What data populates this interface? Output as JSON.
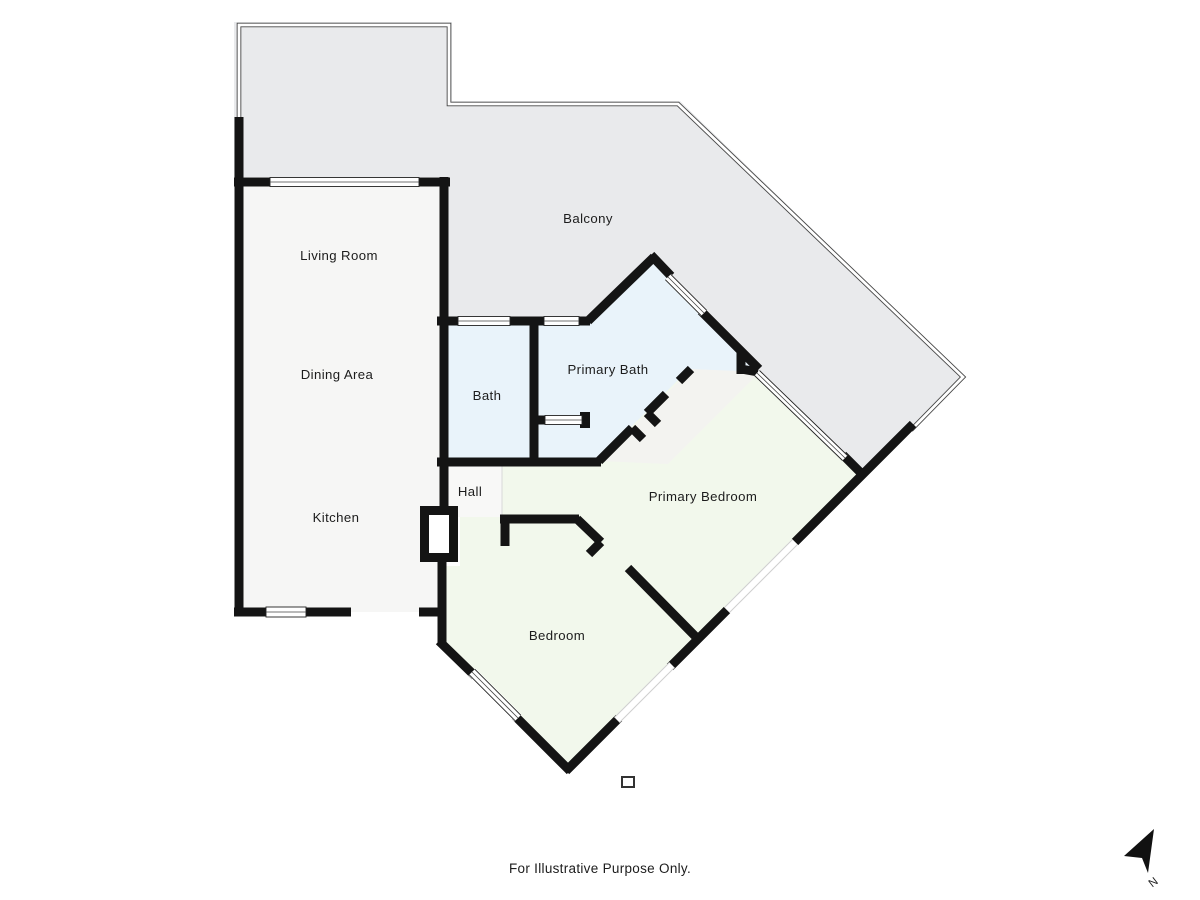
{
  "rooms": [
    {
      "id": "balcony",
      "label": "Balcony"
    },
    {
      "id": "living-room",
      "label": "Living Room"
    },
    {
      "id": "dining-area",
      "label": "Dining Area"
    },
    {
      "id": "kitchen",
      "label": "Kitchen"
    },
    {
      "id": "bath",
      "label": "Bath"
    },
    {
      "id": "primary-bath",
      "label": "Primary Bath"
    },
    {
      "id": "hall",
      "label": "Hall"
    },
    {
      "id": "primary-bedroom",
      "label": "Primary Bedroom"
    },
    {
      "id": "bedroom",
      "label": "Bedroom"
    }
  ],
  "caption": "For Illustrative Purpose Only.",
  "compass": {
    "label": "N"
  },
  "colors": {
    "balcony_fill": "#e9eaec",
    "living_fill": "#f6f6f5",
    "bath_fill": "#e9f3fa",
    "bedroom_fill": "#f2f8ec",
    "hall_fill": "#f8f8f7",
    "wall": "#141414",
    "page_bg": "#ffffff"
  }
}
